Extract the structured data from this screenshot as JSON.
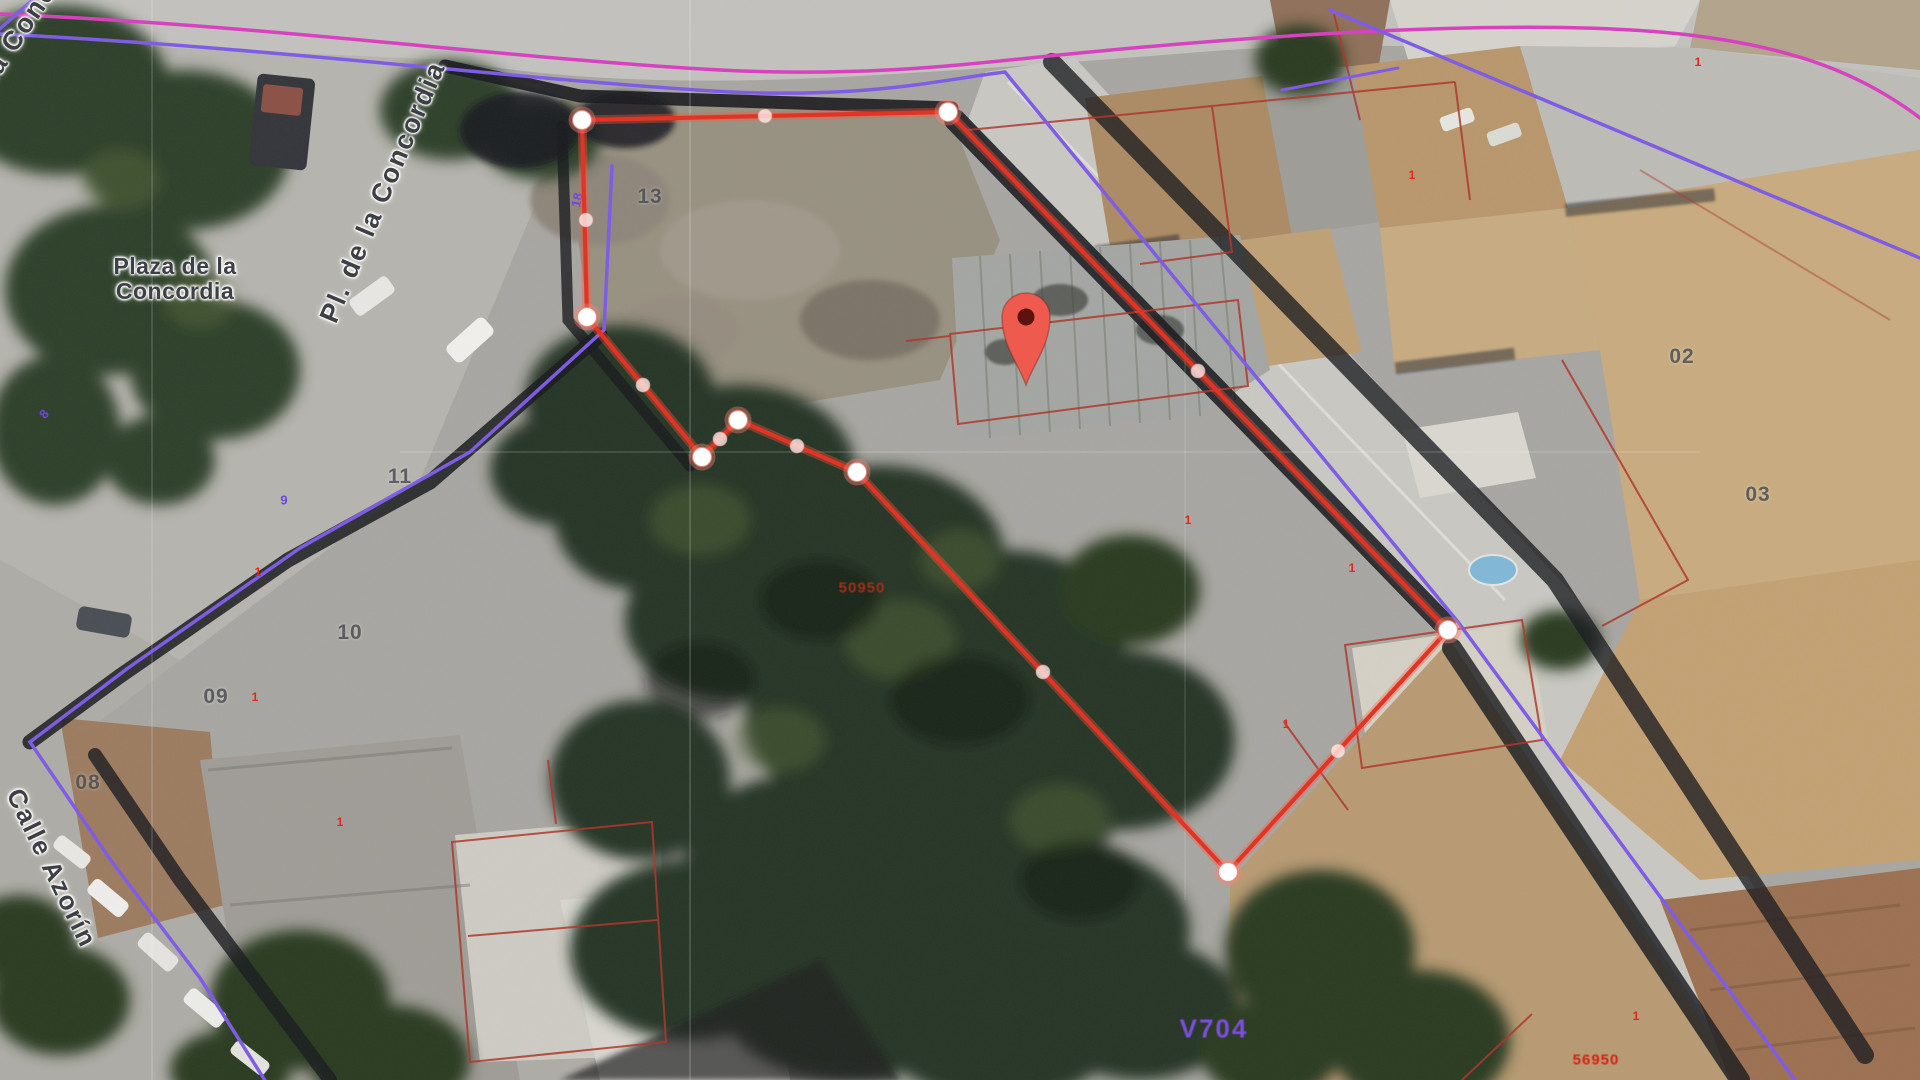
{
  "map": {
    "type": "satellite-cadastral-view",
    "street_labels": [
      {
        "id": "plaza-de-la-concordia",
        "text": "Plaza de la\nConcordia",
        "x": 175,
        "y": 279,
        "rot": 0,
        "size": 23,
        "ls": 0.5
      },
      {
        "id": "pl-de-la-concordia",
        "text": "Pl. de la Concordia",
        "x": 383,
        "y": 192,
        "rot": -67,
        "size": 27,
        "ls": 2
      },
      {
        "id": "pl-de-la-concordia-corner",
        "text": "Pl. de la Concordia",
        "x": 14,
        "y": 40,
        "rot": -56,
        "size": 27,
        "ls": 2
      },
      {
        "id": "calle-azorin",
        "text": "Calle Azorín",
        "x": 52,
        "y": 868,
        "rot": 64,
        "size": 26,
        "ls": 2
      }
    ],
    "parcel_numbers": [
      {
        "text": "13",
        "x": 650,
        "y": 197
      },
      {
        "text": "11",
        "x": 400,
        "y": 477
      },
      {
        "text": "10",
        "x": 350,
        "y": 633
      },
      {
        "text": "09",
        "x": 216,
        "y": 697
      },
      {
        "text": "08",
        "x": 88,
        "y": 783
      },
      {
        "text": "02",
        "x": 1682,
        "y": 357
      },
      {
        "text": "03",
        "x": 1758,
        "y": 495
      }
    ],
    "cadastral_refs": [
      {
        "text": "50950",
        "x": 862,
        "y": 588,
        "color": "#a33018",
        "size": 15
      },
      {
        "text": "56950",
        "x": 1596,
        "y": 1060,
        "color": "#d6200e",
        "size": 15
      }
    ],
    "road_code": {
      "text": "V704",
      "x": 1214,
      "y": 1029,
      "color": "#7c4fe0",
      "size": 26
    },
    "tiny_red_marks": [
      {
        "text": "1",
        "x": 258,
        "y": 572
      },
      {
        "text": "1",
        "x": 255,
        "y": 697
      },
      {
        "text": "1",
        "x": 340,
        "y": 822
      },
      {
        "text": "1",
        "x": 1412,
        "y": 175
      },
      {
        "text": "1",
        "x": 1698,
        "y": 62
      },
      {
        "text": "1",
        "x": 1352,
        "y": 568
      },
      {
        "text": "1",
        "x": 1286,
        "y": 724
      },
      {
        "text": "1",
        "x": 1636,
        "y": 1016
      },
      {
        "text": "1",
        "x": 1188,
        "y": 520
      }
    ],
    "tiny_purple_marks": [
      {
        "text": "18",
        "x": 577,
        "y": 200,
        "rot": -78
      },
      {
        "text": "9",
        "x": 284,
        "y": 500,
        "rot": 0
      },
      {
        "text": "8",
        "x": 44,
        "y": 414,
        "rot": -50
      }
    ]
  },
  "drawing": {
    "parcel_polygon": {
      "stroke": "#e23325",
      "vertices": [
        [
          582,
          120
        ],
        [
          587,
          317
        ],
        [
          702,
          457
        ],
        [
          738,
          420
        ],
        [
          857,
          472
        ],
        [
          1228,
          872
        ],
        [
          1448,
          630
        ],
        [
          948,
          112
        ]
      ]
    },
    "midpoints": [
      [
        586,
        220
      ],
      [
        643,
        385
      ],
      [
        720,
        439
      ],
      [
        797,
        446
      ],
      [
        1043,
        672
      ],
      [
        1338,
        751
      ],
      [
        1198,
        371
      ],
      [
        765,
        116
      ]
    ],
    "vertex_style": {
      "fill": "#ffffff",
      "r": 9.5,
      "halo": "rgba(255,130,115,0.4)"
    },
    "midpoint_style": {
      "fill": "rgba(255,240,238,0.78)",
      "r": 7
    },
    "pin": {
      "x": 1026,
      "y": 385,
      "fill": "#ee5a4e",
      "core": "#5c120d"
    }
  },
  "overlay_colors": {
    "purple": "#7b58e6",
    "magenta": "#d93bbf",
    "cadastral_red": "#ae3226"
  }
}
